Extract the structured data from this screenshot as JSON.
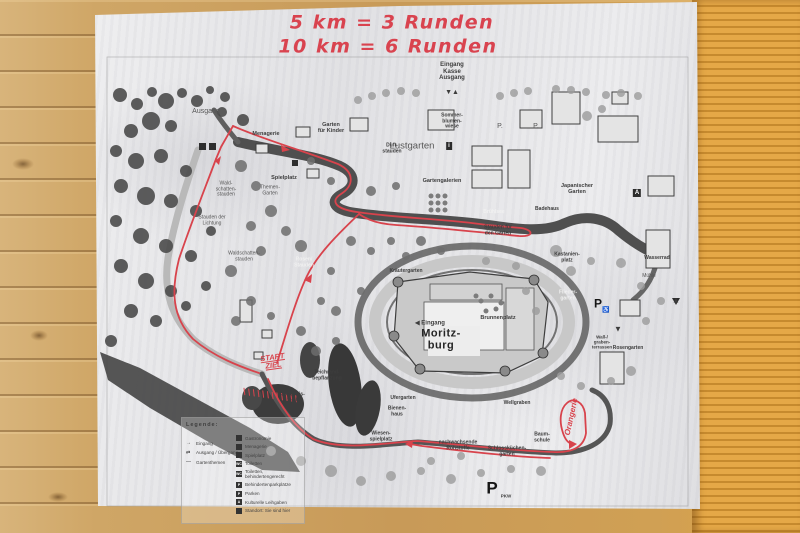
{
  "colors": {
    "route_red": "#d8434c",
    "handwriting_red": "#d9434f",
    "wood": "#c89a58",
    "paper": "#ececee"
  },
  "handwriting": {
    "line1": "5 km  =  3 Runden",
    "line2": "10 km  =  6 Runden",
    "start_finish": "START\nZIEL",
    "loop_note": "Orangerie"
  },
  "map": {
    "title": "Moritzburg Schlosspark (photocopied map)",
    "labels": [
      {
        "t": "5 km  =  3 Runden",
        "x": 392,
        "y": 23,
        "s": 19,
        "c": "hand",
        "n": "handwritten-distance-1"
      },
      {
        "t": "10 km  =  6 Runden",
        "x": 388,
        "y": 47,
        "s": 19,
        "c": "hand",
        "n": "handwritten-distance-2"
      },
      {
        "t": "Eingang\nKasse\nAusgang",
        "x": 452,
        "y": 72,
        "s": 6,
        "c": "lbl",
        "n": "entrance-ticket-label"
      },
      {
        "t": "▼▲",
        "x": 452,
        "y": 93,
        "s": 7,
        "c": "lbl",
        "n": "gate-arrows"
      },
      {
        "t": "Ausgang",
        "x": 206,
        "y": 112,
        "s": 7,
        "c": "lt",
        "n": "exit-label"
      },
      {
        "t": "Menagerie",
        "x": 266,
        "y": 134,
        "s": 5.5,
        "c": "lbl"
      },
      {
        "t": "Garten\nfür Kinder",
        "x": 331,
        "y": 128,
        "s": 5.5,
        "c": "lbl"
      },
      {
        "t": "Duft-\nstauden",
        "x": 392,
        "y": 149,
        "s": 5,
        "c": "lbl"
      },
      {
        "t": "Sommer-\nblumen-\nwiese",
        "x": 452,
        "y": 122,
        "s": 5,
        "c": "lbl"
      },
      {
        "t": "P.",
        "x": 500,
        "y": 127,
        "s": 7,
        "c": "lt",
        "n": "parking-dot-1"
      },
      {
        "t": "P.",
        "x": 536,
        "y": 127,
        "s": 7,
        "c": "lt",
        "n": "parking-dot-2"
      },
      {
        "t": "Lustgarten",
        "x": 412,
        "y": 147,
        "s": 9.5,
        "c": "lt"
      },
      {
        "t": "i",
        "x": 449,
        "y": 146,
        "s": 6,
        "c": "box",
        "n": "info-icon"
      },
      {
        "t": "Gartengalerien",
        "x": 442,
        "y": 181,
        "s": 5.5,
        "c": "lbl"
      },
      {
        "t": "Japanischer\nGarten",
        "x": 577,
        "y": 189,
        "s": 5.5,
        "c": "lbl"
      },
      {
        "t": "A",
        "x": 637,
        "y": 193,
        "s": 6,
        "c": "box",
        "n": "a-marker-icon"
      },
      {
        "t": "Badehaus",
        "x": 547,
        "y": 210,
        "s": 5,
        "c": "lbl"
      },
      {
        "t": "Brühlsee",
        "x": 494,
        "y": 213,
        "s": 5,
        "c": "wh"
      },
      {
        "t": "Stauden für\nden Garten",
        "x": 498,
        "y": 231,
        "s": 5,
        "c": "lbl"
      },
      {
        "t": "Themen-\nGarten",
        "x": 270,
        "y": 191,
        "s": 5,
        "c": "lt"
      },
      {
        "t": "Wald-\nschatten-\nstauden",
        "x": 226,
        "y": 190,
        "s": 5,
        "c": "lt"
      },
      {
        "t": "Stauden der\nLichtung",
        "x": 212,
        "y": 221,
        "s": 5,
        "c": "lt"
      },
      {
        "t": "Waldschatten-\nstauden",
        "x": 244,
        "y": 257,
        "s": 5,
        "c": "lt"
      },
      {
        "t": "Rosen/\nStauden",
        "x": 304,
        "y": 263,
        "s": 5,
        "c": "wh"
      },
      {
        "t": "Spielplatz",
        "x": 284,
        "y": 178,
        "s": 5.5,
        "c": "lbl"
      },
      {
        "t": "Kräutergarten",
        "x": 406,
        "y": 272,
        "s": 5,
        "c": "lbl"
      },
      {
        "t": "◀ Eingang",
        "x": 430,
        "y": 324,
        "s": 6,
        "c": "lbl",
        "n": "castle-entrance-label"
      },
      {
        "t": "Moritz-\nburg",
        "x": 441,
        "y": 340,
        "s": 11,
        "c": "big",
        "n": "castle-name"
      },
      {
        "t": "Brunnenplatz",
        "x": 498,
        "y": 318,
        "s": 5.5,
        "c": "lbl"
      },
      {
        "t": "Flieder-\ngarten",
        "x": 568,
        "y": 296,
        "s": 5,
        "c": "wh"
      },
      {
        "t": "Wall-/\ngraben-\nterrassen",
        "x": 602,
        "y": 342,
        "s": 4.5,
        "c": "lbl"
      },
      {
        "t": "Rosengarten",
        "x": 628,
        "y": 349,
        "s": 5,
        "c": "lbl"
      },
      {
        "t": "Kastanien-\nplatz",
        "x": 567,
        "y": 258,
        "s": 5,
        "c": "lbl"
      },
      {
        "t": "Wasserrad",
        "x": 657,
        "y": 259,
        "s": 5,
        "c": "lbl"
      },
      {
        "t": "Mühle",
        "x": 649,
        "y": 277,
        "s": 5,
        "c": "lt"
      },
      {
        "t": "▲",
        "x": 676,
        "y": 301,
        "s": 8,
        "c": "lbl",
        "n": "direction-triangle-up"
      },
      {
        "t": "▼",
        "x": 618,
        "y": 330,
        "s": 8,
        "c": "lbl",
        "n": "direction-triangle-down"
      },
      {
        "t": "P",
        "x": 598,
        "y": 304,
        "s": 12,
        "c": "Pmid",
        "n": "accessible-parking-p"
      },
      {
        "t": "♿",
        "x": 606,
        "y": 311,
        "s": 6,
        "c": "lbl",
        "n": "wheelchair-icon"
      },
      {
        "t": "START\nZIEL",
        "x": 273,
        "y": 362,
        "s": 7.5,
        "c": "red",
        "r": -8,
        "u": 1,
        "n": "start-finish-label"
      },
      {
        "t": "Teichrand-\nbepflanzung",
        "x": 327,
        "y": 376,
        "s": 5,
        "c": "lbl"
      },
      {
        "t": "Johannis-\nteich",
        "x": 293,
        "y": 398,
        "s": 5,
        "c": "lbl"
      },
      {
        "t": "Ufergarten",
        "x": 403,
        "y": 399,
        "s": 5,
        "c": "lbl"
      },
      {
        "t": "Bienen-\nhaus",
        "x": 397,
        "y": 412,
        "s": 5,
        "c": "lbl"
      },
      {
        "t": "Wellgraben",
        "x": 517,
        "y": 404,
        "s": 5,
        "c": "lbl"
      },
      {
        "t": "Baum-\nschule",
        "x": 542,
        "y": 438,
        "s": 5,
        "c": "lbl"
      },
      {
        "t": "Schlossküchen-\ngarten",
        "x": 507,
        "y": 452,
        "s": 5,
        "c": "lbl"
      },
      {
        "t": "nachwachsende\nRohstoffe",
        "x": 458,
        "y": 446,
        "s": 5,
        "c": "lbl"
      },
      {
        "t": "Wiesen-\nspielplatz",
        "x": 381,
        "y": 437,
        "s": 5,
        "c": "lbl"
      },
      {
        "t": "Orangerie",
        "x": 572,
        "y": 417,
        "s": 8,
        "c": "red",
        "r": -78,
        "n": "handwritten-loop-label"
      },
      {
        "t": "P",
        "x": 492,
        "y": 488,
        "s": 17,
        "c": "Pbig",
        "n": "car-parking-p"
      },
      {
        "t": "PKW",
        "x": 506,
        "y": 496,
        "s": 4.5,
        "c": "lbl",
        "n": "car-parking-sub"
      }
    ]
  },
  "legend": {
    "title": "Legende:",
    "left": [
      {
        "icon": "→",
        "label": "Eingang"
      },
      {
        "icon": "⇄",
        "label": "Ausgang / Übergang"
      },
      {
        "icon": "—",
        "label": "Gartenthemen"
      }
    ],
    "right": [
      {
        "icon": "",
        "label": "Gastronomie"
      },
      {
        "icon": "",
        "label": "Menagerie"
      },
      {
        "icon": "",
        "label": "Spielplatz"
      },
      {
        "icon": "WC",
        "label": "Toiletten"
      },
      {
        "icon": "WC",
        "label": "Toiletten, behindertengerecht"
      },
      {
        "icon": "P",
        "label": "Behindertenparkplätze"
      },
      {
        "icon": "P",
        "label": "Parken"
      },
      {
        "icon": "A",
        "label": "Kulturelle Leihgaben"
      },
      {
        "icon": "",
        "label": "Standort: Sie sind hier"
      }
    ]
  }
}
